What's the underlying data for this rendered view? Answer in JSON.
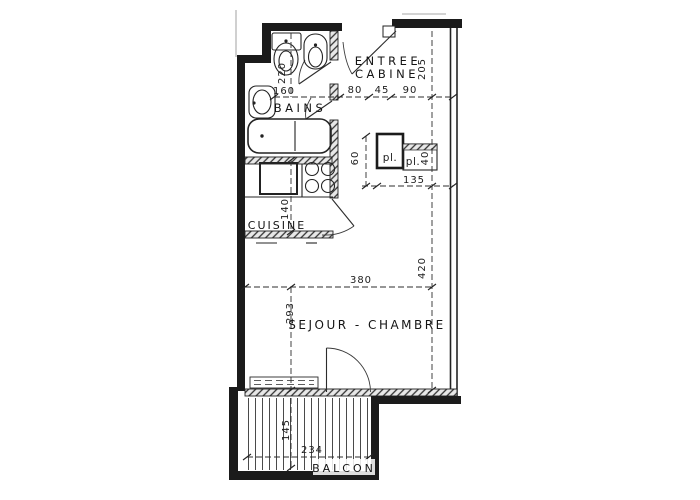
{
  "drawing_type": "apartment floor plan",
  "colors": {
    "ink": "#1b1b1b",
    "paper": "#ffffff"
  },
  "rooms": {
    "entree": "ENTREE",
    "cabine": "CABINE",
    "bains": "BAINS",
    "cuisine": "CUISINE",
    "sejour": "SEJOUR - CHAMBRE",
    "balcon": "BALCON",
    "placard_left": "pl.",
    "placard_right": "pl."
  },
  "dims": {
    "w80": "80",
    "w45": "45",
    "w90": "90",
    "d205": "205",
    "d220": "220",
    "w160": "160",
    "d60": "60",
    "d40": "40",
    "w135": "135",
    "d140": "140",
    "w380": "380",
    "d420": "420",
    "d293": "293",
    "d145": "145",
    "w234": "234"
  }
}
